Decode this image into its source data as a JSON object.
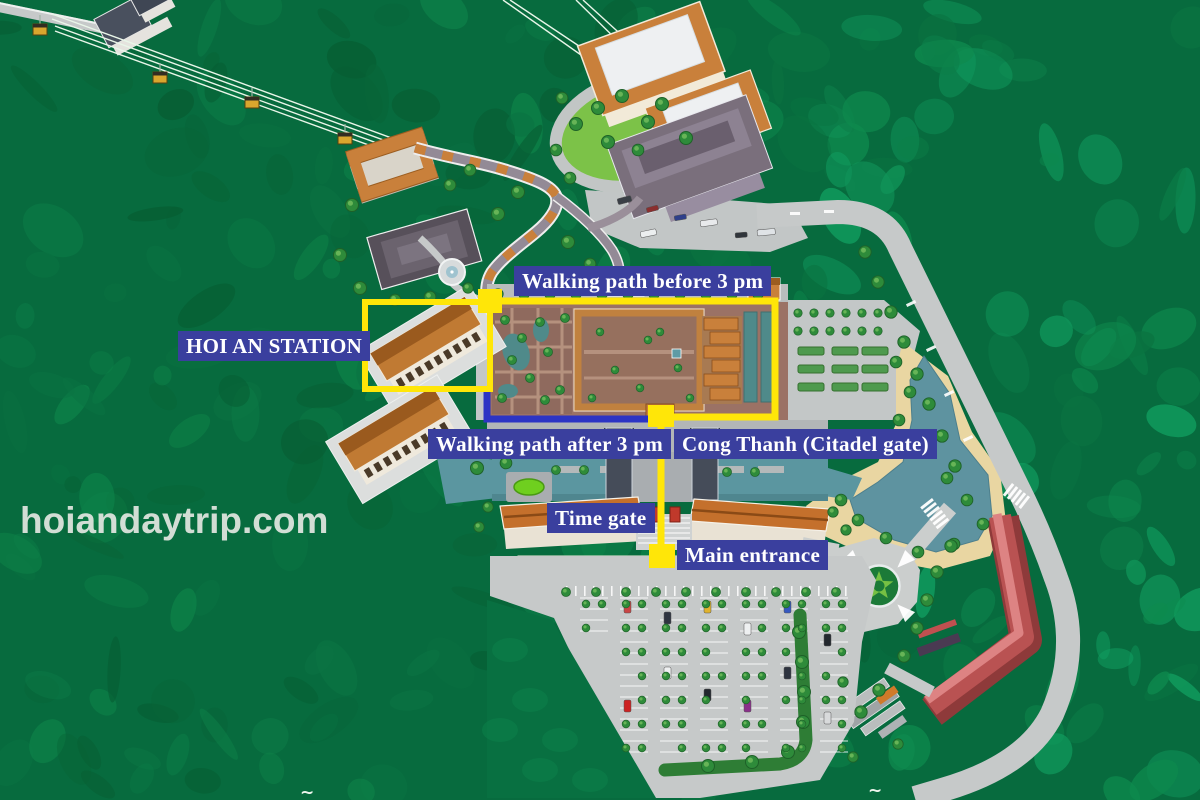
{
  "watermark": "hoiandaytrip.com",
  "labels": {
    "walking_before": "Walking path before 3 pm",
    "station": "HOI AN STATION",
    "walking_after": "Walking path after 3 pm",
    "citadel_gate": "Cong Thanh (Citadel gate)",
    "time_gate": "Time gate",
    "main_entrance": "Main entrance"
  },
  "routes": [
    {
      "name": "Walking path before 3 pm",
      "color": "#ffe608"
    },
    {
      "name": "Walking path after 3 pm",
      "color": "#2c34c4"
    }
  ],
  "colors": {
    "label_background": "#3a3f9e",
    "label_text": "#ffffff",
    "highlight_yellow": "#ffe608",
    "route_blue": "#2c34c4",
    "forest_green": "#087243",
    "water_teal": "#5e93a0",
    "road_gray": "#c6c9c9",
    "sand": "#e9d6a2",
    "red_building": "#c05555"
  },
  "decor_marks": [
    "~",
    "~"
  ]
}
